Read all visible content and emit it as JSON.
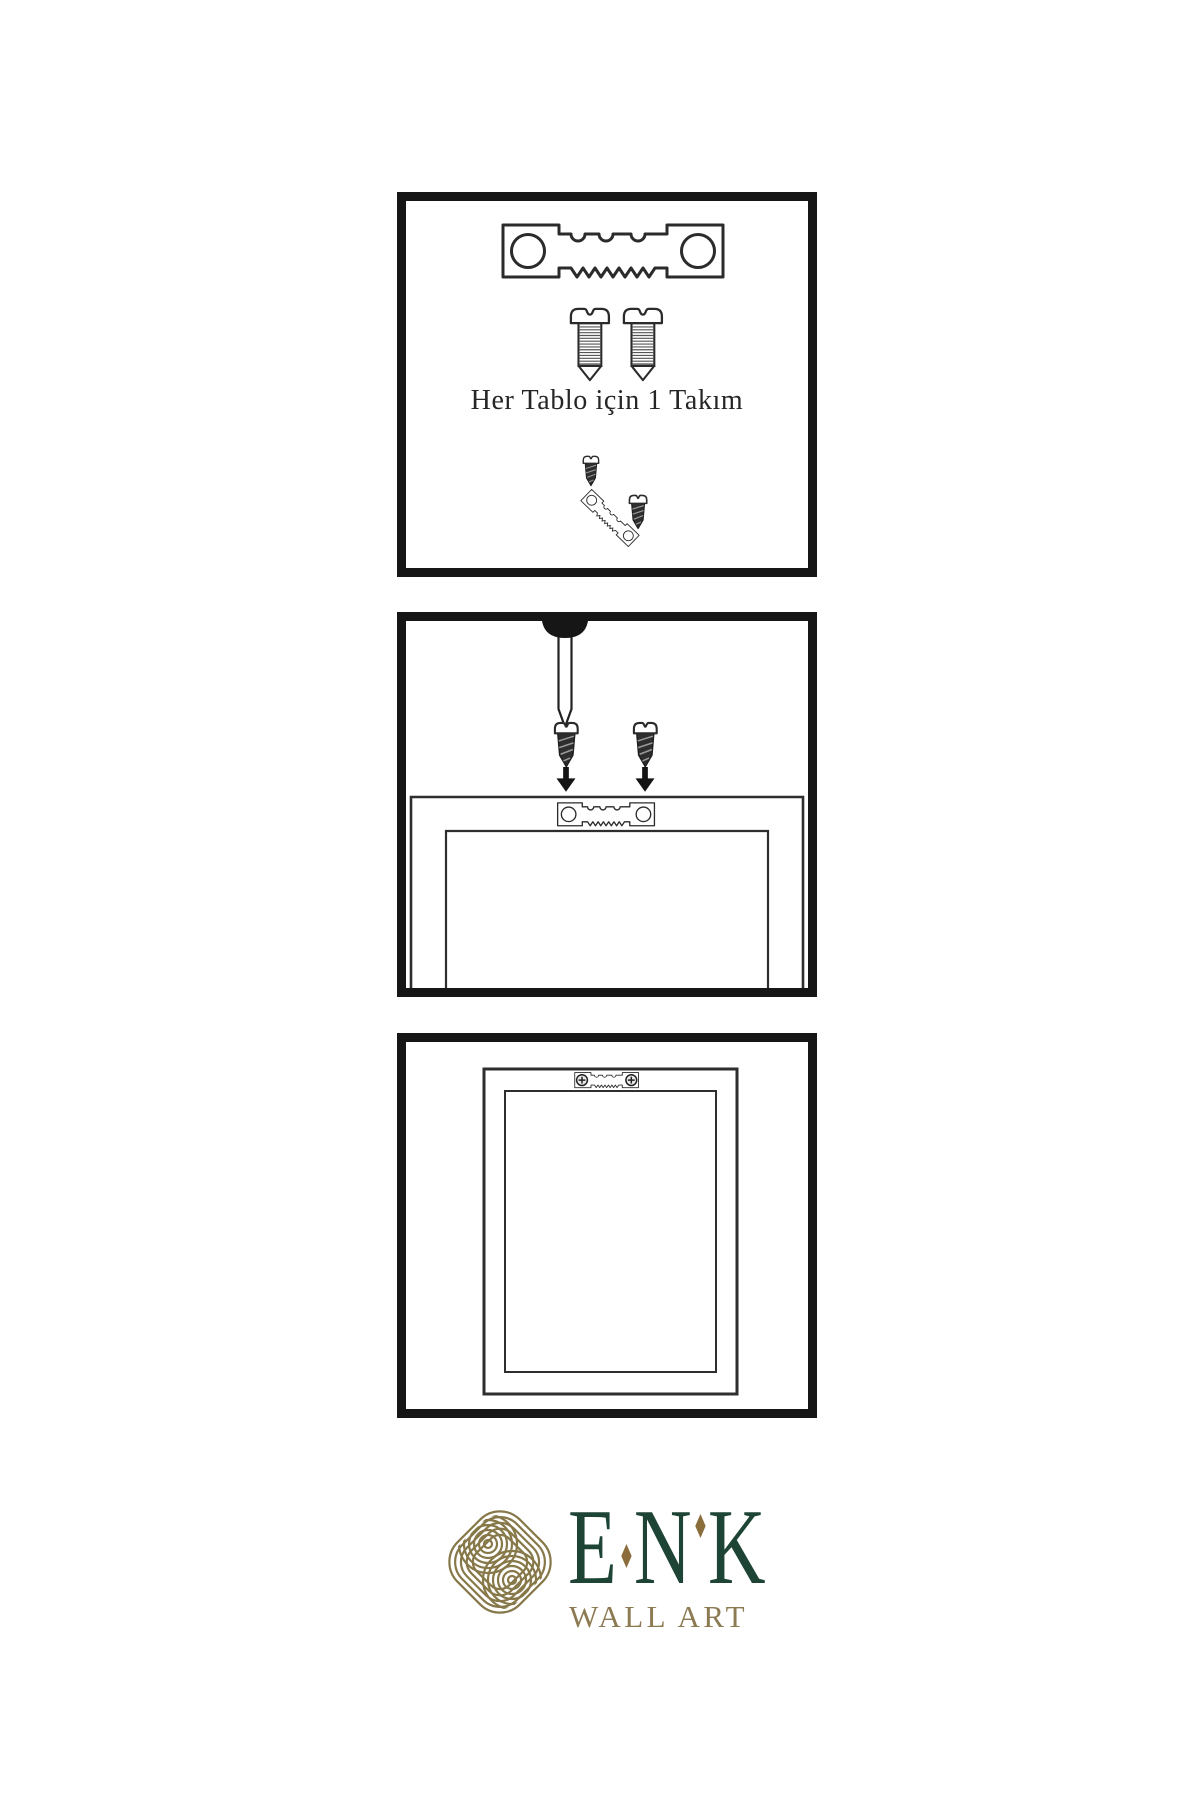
{
  "page": {
    "background": "#ffffff",
    "type": "wall-art-hanging-instructions"
  },
  "panel1": {
    "caption": "Her Tablo için 1 Takım",
    "items": [
      "sawtooth-hanger",
      "screw",
      "screw",
      "small-screw",
      "tilted-sawtooth-hanger-with-screw"
    ]
  },
  "panel2": {
    "items": [
      "wall-nail",
      "screw-with-down-arrow",
      "screw-with-down-arrow",
      "frame-back-outline",
      "sawtooth-hanger-mounted"
    ]
  },
  "panel3": {
    "items": [
      "picture-frame-hanging",
      "sawtooth-hanger-installed-with-phillips-screws"
    ]
  },
  "logo": {
    "brand": "ENK",
    "brand_letters": [
      "E",
      "N",
      "K"
    ],
    "subtitle": "WALL ART",
    "colors": {
      "brand_green": "#1d4434",
      "accent_gold": "#8a6d3b",
      "subtitle_gold": "#8c7a52",
      "knot_olive": "#867848"
    }
  },
  "colors": {
    "line_art": "#2b2b2b",
    "panel_border": "#161616",
    "dark_screw_fill": "#2e2e2e",
    "background": "#ffffff"
  }
}
